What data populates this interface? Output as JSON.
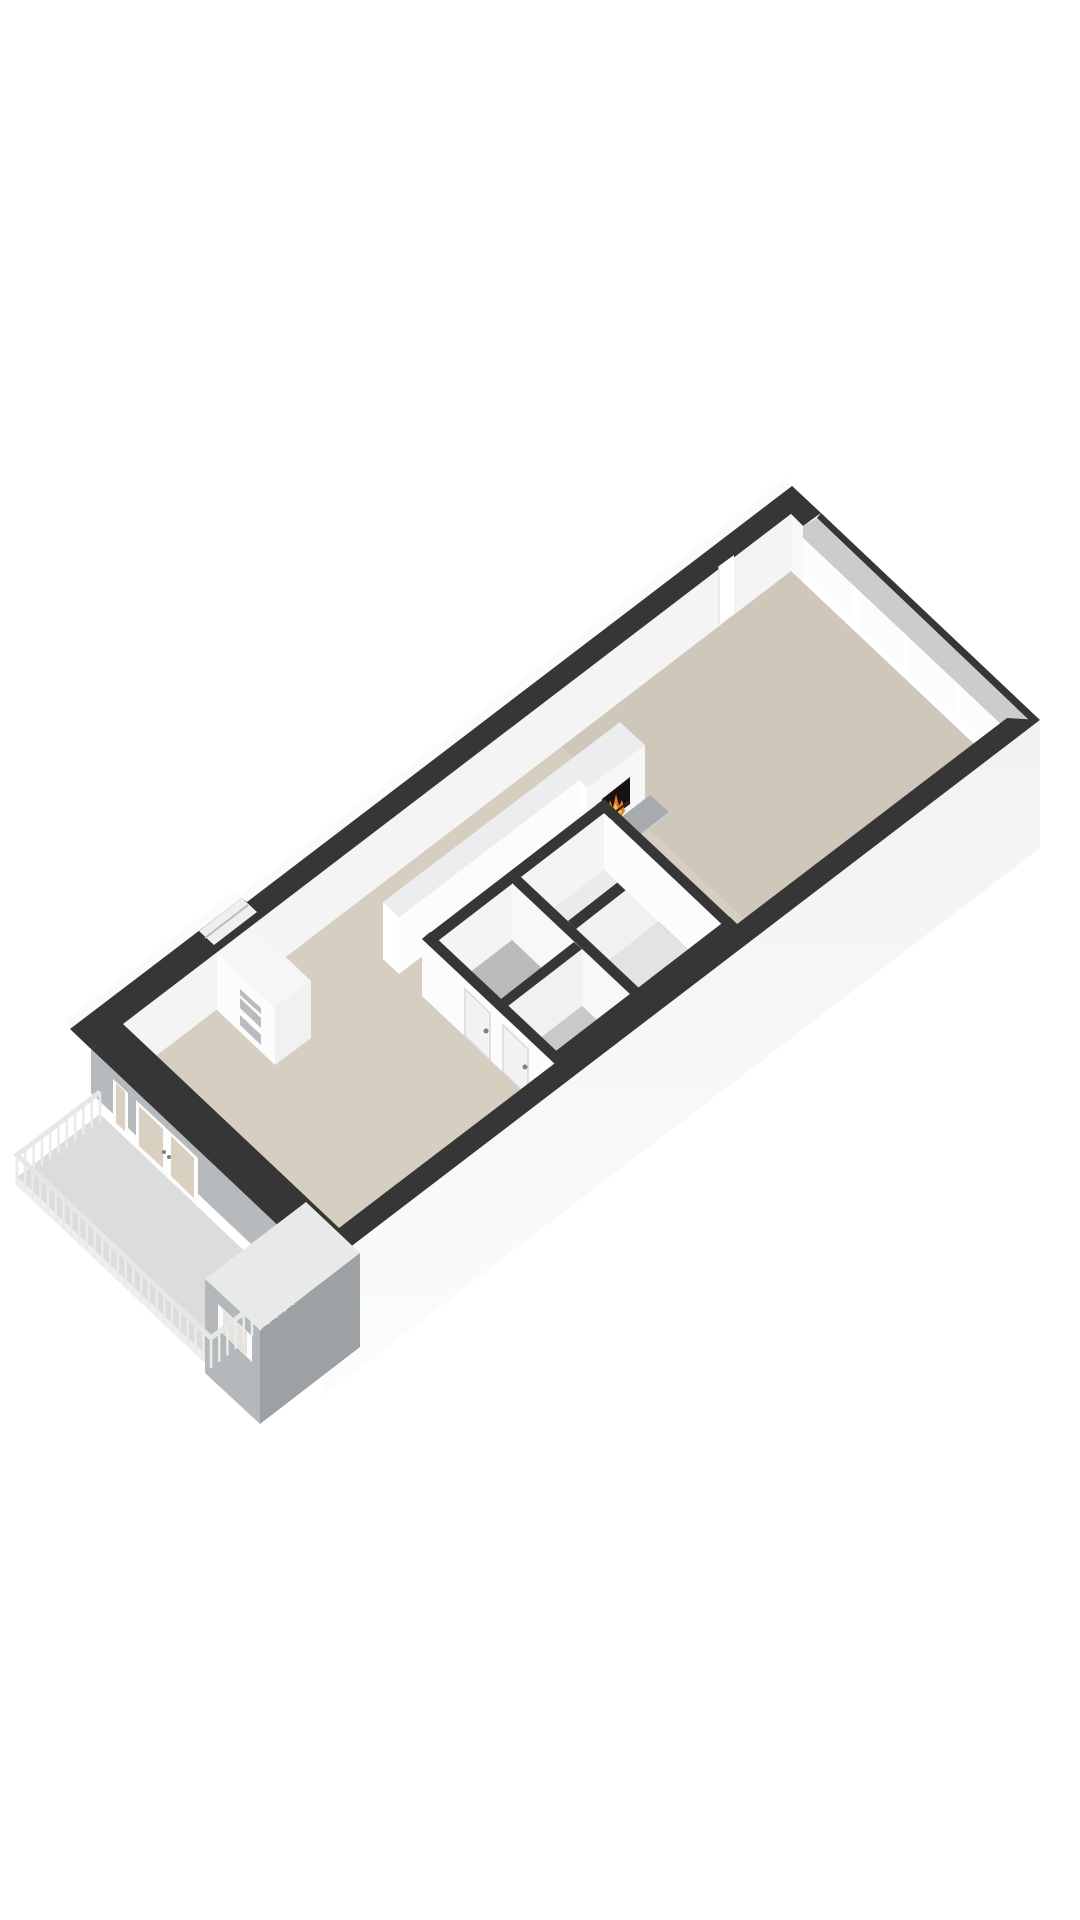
{
  "scene": {
    "type": "3d-floorplan-render",
    "view": "isometric-from-southwest",
    "background": "#ffffff",
    "visible_text": []
  },
  "palette": {
    "bg": "#ffffff",
    "wallTopDark": "#363636",
    "wallTopLight": "#ecedee",
    "sliver": "#fbfbfb",
    "innerNW": "#f4f4f5",
    "faceWhite": "#fcfcfd",
    "faceBright": "#ffffff",
    "faceSoft": "#f6f6f7",
    "faceLight": "#f3f4f4",
    "faceLighter": "#f8f8f9",
    "facePale": "#f0f1f1",
    "faceShadow": "#b7babc",
    "faceShadowDark": "#9da1a4",
    "bayFace": "#b4b8ba",
    "bayTop": "#e8e9e9",
    "clusterSE": "#e8e9ea",
    "floorLiving": "#cfc8ba",
    "floorHall": "#d6cfc1",
    "floorBathA": "#b9bbbd",
    "floorBathB": "#c7c9ca",
    "floorRoomA": "#eaebeb",
    "floorRoomB": "#e2e3e4",
    "glass": "#fbfcfd",
    "lintel": "#caccce",
    "doorGlass": "#d9d0c1",
    "bayGlass": "#e7e3da",
    "hearthTop": "#a7abae",
    "hearthEdge": "#c9ccce",
    "hearthEdge2": "#d7d9da",
    "fireDark": "#171210",
    "log": "#3a2413",
    "flameOrange": "#e07b28",
    "flameYellow": "#f7c347",
    "slab": "#dcdcda",
    "slabEdge": "#efefef",
    "slabEdge2": "#e4e4e4",
    "rail": "#e6e7e7",
    "post": "#e9eaea",
    "niche": "#b9bcbe",
    "slot": "#eef0f0",
    "doorLeaf": "#f2f2f3",
    "doorEdge": "#d8d9da",
    "handle": "#7c8082",
    "facadeA": "#f1f2f2",
    "facadeB": "#fcfcfc"
  },
  "building": {
    "rooms": [
      "living-room",
      "hallway",
      "entrance-hall",
      "bathroom",
      "second-bathroom",
      "toilet",
      "storage-room",
      "balcony"
    ],
    "fireplace": {
      "present": true,
      "type": "built-in-stove",
      "flame_visible": true,
      "hearth": "grey-plinth"
    },
    "window_wall": {
      "location": "northeast",
      "panes": 4,
      "mullions": 3
    },
    "nw_wall_slot_window": {
      "present": true
    },
    "niche_block": {
      "openings": 3
    },
    "interior_doors": {
      "visible": 2,
      "handles": true
    },
    "french_doors": {
      "leaves": 2,
      "sidelight": true,
      "handles": 2
    },
    "bay_volume": {
      "window": true
    },
    "balcony": {
      "railing_segments": [
        {
          "x1": 100,
          "y1": 1092,
          "x2": 17,
          "y2": 1155,
          "posts": 11,
          "post_length": 30
        },
        {
          "x1": 17,
          "y1": 1155,
          "x2": 211,
          "y2": 1338,
          "posts": 26,
          "post_length": 30
        },
        {
          "x1": 211,
          "y1": 1338,
          "x2": 293,
          "y2": 1275,
          "posts": 11,
          "post_length": 30
        }
      ]
    }
  }
}
